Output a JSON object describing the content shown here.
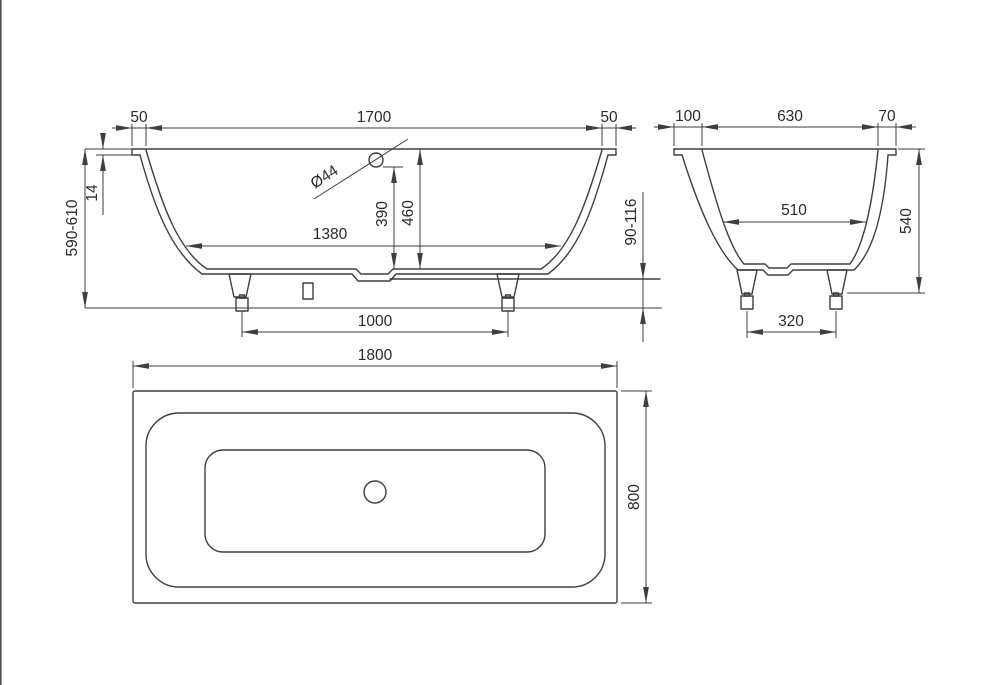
{
  "drawing": {
    "subject": "bathtub-dimension-drawing",
    "unit_system": "mm"
  },
  "front_view": {
    "rim_overhang_left": "50",
    "opening_length": "1700",
    "rim_overhang_right": "50",
    "rim_thickness": "14",
    "overall_height": "590-610",
    "overflow_diameter": "Ø44",
    "overflow_height": "390",
    "inner_depth": "460",
    "bottom_length": "1380",
    "feet_spacing": "1000",
    "feet_height_range": "90-116"
  },
  "end_view": {
    "rim_overhang_left": "100",
    "opening_width": "630",
    "rim_overhang_right": "70",
    "bottom_width": "510",
    "body_height": "540",
    "feet_spacing": "320"
  },
  "plan_view": {
    "overall_length": "1800",
    "overall_width": "800"
  },
  "colors": {
    "line": "#3e3e3e",
    "text": "#2a2a2a",
    "background": "#ffffff",
    "edge_border": "#4b4b4b"
  }
}
